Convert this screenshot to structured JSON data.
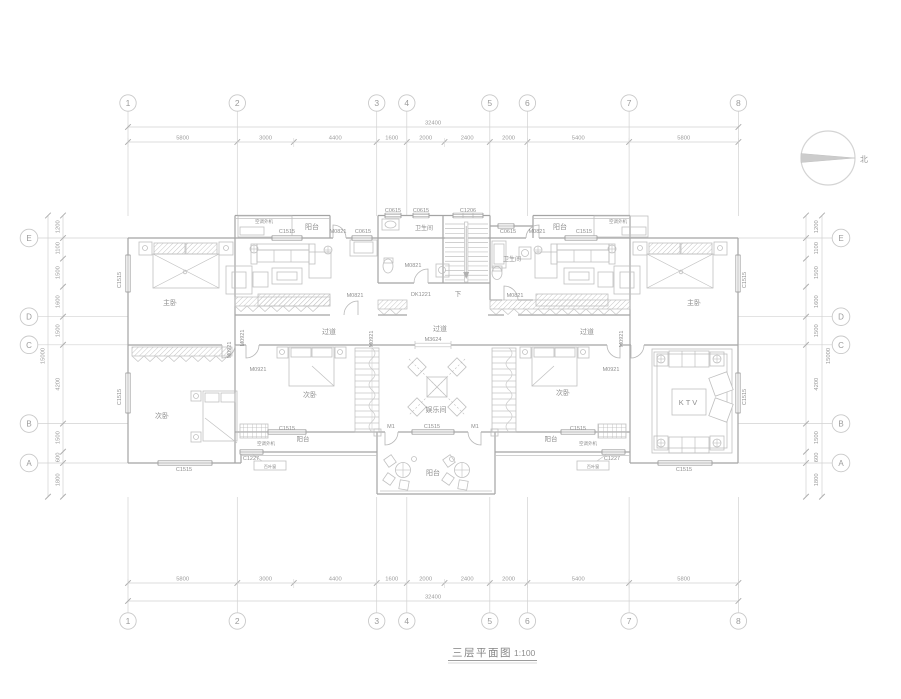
{
  "drawing": {
    "title": "三层平面图",
    "scale": "1:100",
    "north_label": "北"
  },
  "grid": {
    "top_numbers": [
      "1",
      "2",
      "3",
      "4",
      "5",
      "6",
      "7",
      "8"
    ],
    "bottom_numbers": [
      "1",
      "2",
      "3",
      "4",
      "5",
      "6",
      "7",
      "8"
    ],
    "left_letters": [
      "E",
      "D",
      "C",
      "B",
      "A"
    ],
    "right_letters": [
      "E",
      "D",
      "C",
      "B",
      "A"
    ]
  },
  "dimensions": {
    "h_total": "32400",
    "h_segments": [
      "5800",
      "3000",
      "4400",
      "1600",
      "2000",
      "2400",
      "2000",
      "5400",
      "5800"
    ],
    "v_total": "15000",
    "v_segments": [
      "1200",
      "1100",
      "1500",
      "1600",
      "1500",
      "4200",
      "1500",
      "600",
      "1800"
    ]
  },
  "plan_labels": [
    {
      "t": "C0615",
      "x": 393,
      "y": 212
    },
    {
      "t": "C0615",
      "x": 421,
      "y": 212
    },
    {
      "t": "C1206",
      "x": 468,
      "y": 212
    },
    {
      "t": "空调外机",
      "x": 264,
      "y": 223,
      "fs": 4.5
    },
    {
      "t": "空调外机",
      "x": 618,
      "y": 223,
      "fs": 4.5
    },
    {
      "t": "C1515",
      "x": 287,
      "y": 233
    },
    {
      "t": "阳台",
      "x": 312,
      "y": 229,
      "fs": 7
    },
    {
      "t": "M0821",
      "x": 338,
      "y": 233
    },
    {
      "t": "C0615",
      "x": 363,
      "y": 233
    },
    {
      "t": "C0615",
      "x": 508,
      "y": 233
    },
    {
      "t": "M0821",
      "x": 537,
      "y": 233
    },
    {
      "t": "阳台",
      "x": 560,
      "y": 229,
      "fs": 7
    },
    {
      "t": "C1515",
      "x": 584,
      "y": 233
    },
    {
      "t": "卫生间",
      "x": 424,
      "y": 230,
      "fs": 6
    },
    {
      "t": "卫生间",
      "x": 512,
      "y": 261,
      "fs": 6
    },
    {
      "t": "M0821",
      "x": 413,
      "y": 267
    },
    {
      "t": "M0821",
      "x": 355,
      "y": 297
    },
    {
      "t": "DK1221",
      "x": 421,
      "y": 296
    },
    {
      "t": "下",
      "x": 458,
      "y": 296,
      "fs": 6.5
    },
    {
      "t": "M0821",
      "x": 515,
      "y": 297
    },
    {
      "t": "主卧",
      "x": 170,
      "y": 305,
      "fs": 7
    },
    {
      "t": "主卧",
      "x": 694,
      "y": 305,
      "fs": 7
    },
    {
      "t": "C1515",
      "x": 121,
      "y": 280,
      "rot": true
    },
    {
      "t": "C1515",
      "x": 121,
      "y": 397,
      "rot": true
    },
    {
      "t": "C1515",
      "x": 746,
      "y": 280,
      "rot": true
    },
    {
      "t": "C1515",
      "x": 746,
      "y": 397,
      "rot": true
    },
    {
      "t": "过道",
      "x": 329,
      "y": 334,
      "fs": 7
    },
    {
      "t": "过道",
      "x": 440,
      "y": 331,
      "fs": 7
    },
    {
      "t": "M3624",
      "x": 433,
      "y": 341
    },
    {
      "t": "过道",
      "x": 587,
      "y": 334,
      "fs": 7
    },
    {
      "t": "M0921",
      "x": 231,
      "y": 350,
      "rot": true
    },
    {
      "t": "M0921",
      "x": 244,
      "y": 338,
      "rot": true
    },
    {
      "t": "M0921",
      "x": 258,
      "y": 371
    },
    {
      "t": "M0921",
      "x": 373,
      "y": 339,
      "rot": true
    },
    {
      "t": "M0921",
      "x": 623,
      "y": 339,
      "rot": true
    },
    {
      "t": "M0921",
      "x": 611,
      "y": 371
    },
    {
      "t": "次卧",
      "x": 310,
      "y": 397,
      "fs": 7
    },
    {
      "t": "次卧",
      "x": 162,
      "y": 418,
      "fs": 7
    },
    {
      "t": "次卧",
      "x": 563,
      "y": 395,
      "fs": 7
    },
    {
      "t": "娱乐间",
      "x": 436,
      "y": 412,
      "fs": 7
    },
    {
      "t": "KTV",
      "x": 689,
      "y": 405,
      "fs": 7.5,
      "ls": 2
    },
    {
      "t": "M1",
      "x": 391,
      "y": 428
    },
    {
      "t": "C1515",
      "x": 432,
      "y": 428
    },
    {
      "t": "M1",
      "x": 475,
      "y": 428
    },
    {
      "t": "C1515",
      "x": 287,
      "y": 430
    },
    {
      "t": "C1515",
      "x": 578,
      "y": 430
    },
    {
      "t": "空调外机",
      "x": 266,
      "y": 445,
      "fs": 4.5
    },
    {
      "t": "空调外机",
      "x": 588,
      "y": 445,
      "fs": 4.5
    },
    {
      "t": "阳台",
      "x": 303,
      "y": 441,
      "fs": 6.5
    },
    {
      "t": "阳台",
      "x": 551,
      "y": 441,
      "fs": 6.5
    },
    {
      "t": "C1227",
      "x": 251,
      "y": 460
    },
    {
      "t": "C1227",
      "x": 612,
      "y": 460
    },
    {
      "t": "百叶窗",
      "x": 270,
      "y": 468,
      "fs": 4.2
    },
    {
      "t": "百叶窗",
      "x": 593,
      "y": 468,
      "fs": 4.2
    },
    {
      "t": "阳台",
      "x": 433,
      "y": 475,
      "fs": 7
    },
    {
      "t": "C1515",
      "x": 184,
      "y": 471
    },
    {
      "t": "C1515",
      "x": 684,
      "y": 471
    }
  ]
}
